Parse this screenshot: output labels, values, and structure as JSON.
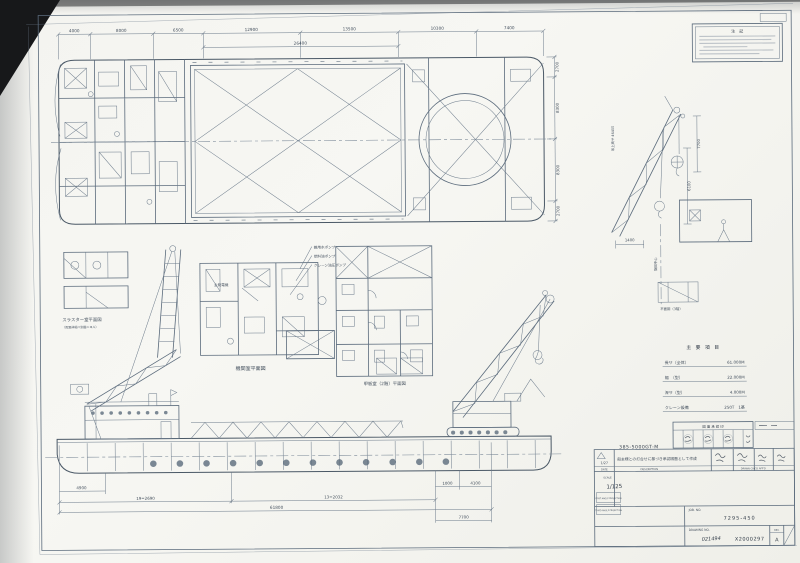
{
  "notes": {
    "title": "注　記"
  },
  "plan": {
    "dims_top": [
      "4000",
      "8000",
      "6500",
      "12900",
      "13500",
      "10300",
      "7400"
    ],
    "dim_mid": "26400",
    "dims_right": [
      "2700",
      "8300",
      "8300",
      "2700"
    ]
  },
  "details": {
    "thruster_label": "スラスター室平面図",
    "thruster_note": "（配置詳細ハ別図ニヨル）",
    "engine_room_label": "機関室平面図",
    "deckhouse_label": "甲板室（2階）平面図",
    "platform_label": "平面図（3階）"
  },
  "annotations": {
    "pump1": "雑用水ポンプ",
    "pump2": "燃料油ポンプ",
    "pump3": "クレーン油圧ポンプ",
    "main_engine": "主発電機"
  },
  "crane_detail": {
    "dim_a": "7700",
    "dim_b": "6100",
    "dim_c": "1400",
    "hoist": "吊上高サ 46400",
    "swing_center": "旋回中心"
  },
  "spec_table": {
    "title": "主 要 項 目",
    "rows": [
      {
        "label": "長サ（全体）",
        "value": "61.000M"
      },
      {
        "label": "幅　（型）",
        "value": "22.000M"
      },
      {
        "label": "深サ（型）",
        "value": "4.000M"
      },
      {
        "label": "クレーン設備",
        "value": "250T　1基"
      }
    ]
  },
  "elevation": {
    "dim_seg1": "4900",
    "dim_span1": "19=2690",
    "dim_span2": "13=2032",
    "dim_total": "61800",
    "dim_r1": "1000",
    "dim_r2": "4100",
    "dim_r3": "7700"
  },
  "title_block": {
    "stamp_header": "図 面 承 認 印",
    "model_no": "385-5000GT-M",
    "rev_date": "1/27",
    "date_label": "DATE",
    "desc_label": "DESCRIPTION",
    "approval_label": "DRAWN  CHK'D  APP'D",
    "rev_desc": "船主様との打合せに基づき承認図面として作成",
    "scale_label": "SCALE",
    "scale_value": "1/125",
    "projection_first": "FIRST ANGLE PROJECTION",
    "projection_third": "THIRD ANGLE PROJECTION",
    "job_no_label": "JOB. NO.",
    "job_no": "7295-450",
    "drawing_no_label": "DRAWING NO.",
    "drawing_no_hand": "021494",
    "drawing_no": "X2000297",
    "rev_label": "REV.",
    "rev_value": "A"
  }
}
